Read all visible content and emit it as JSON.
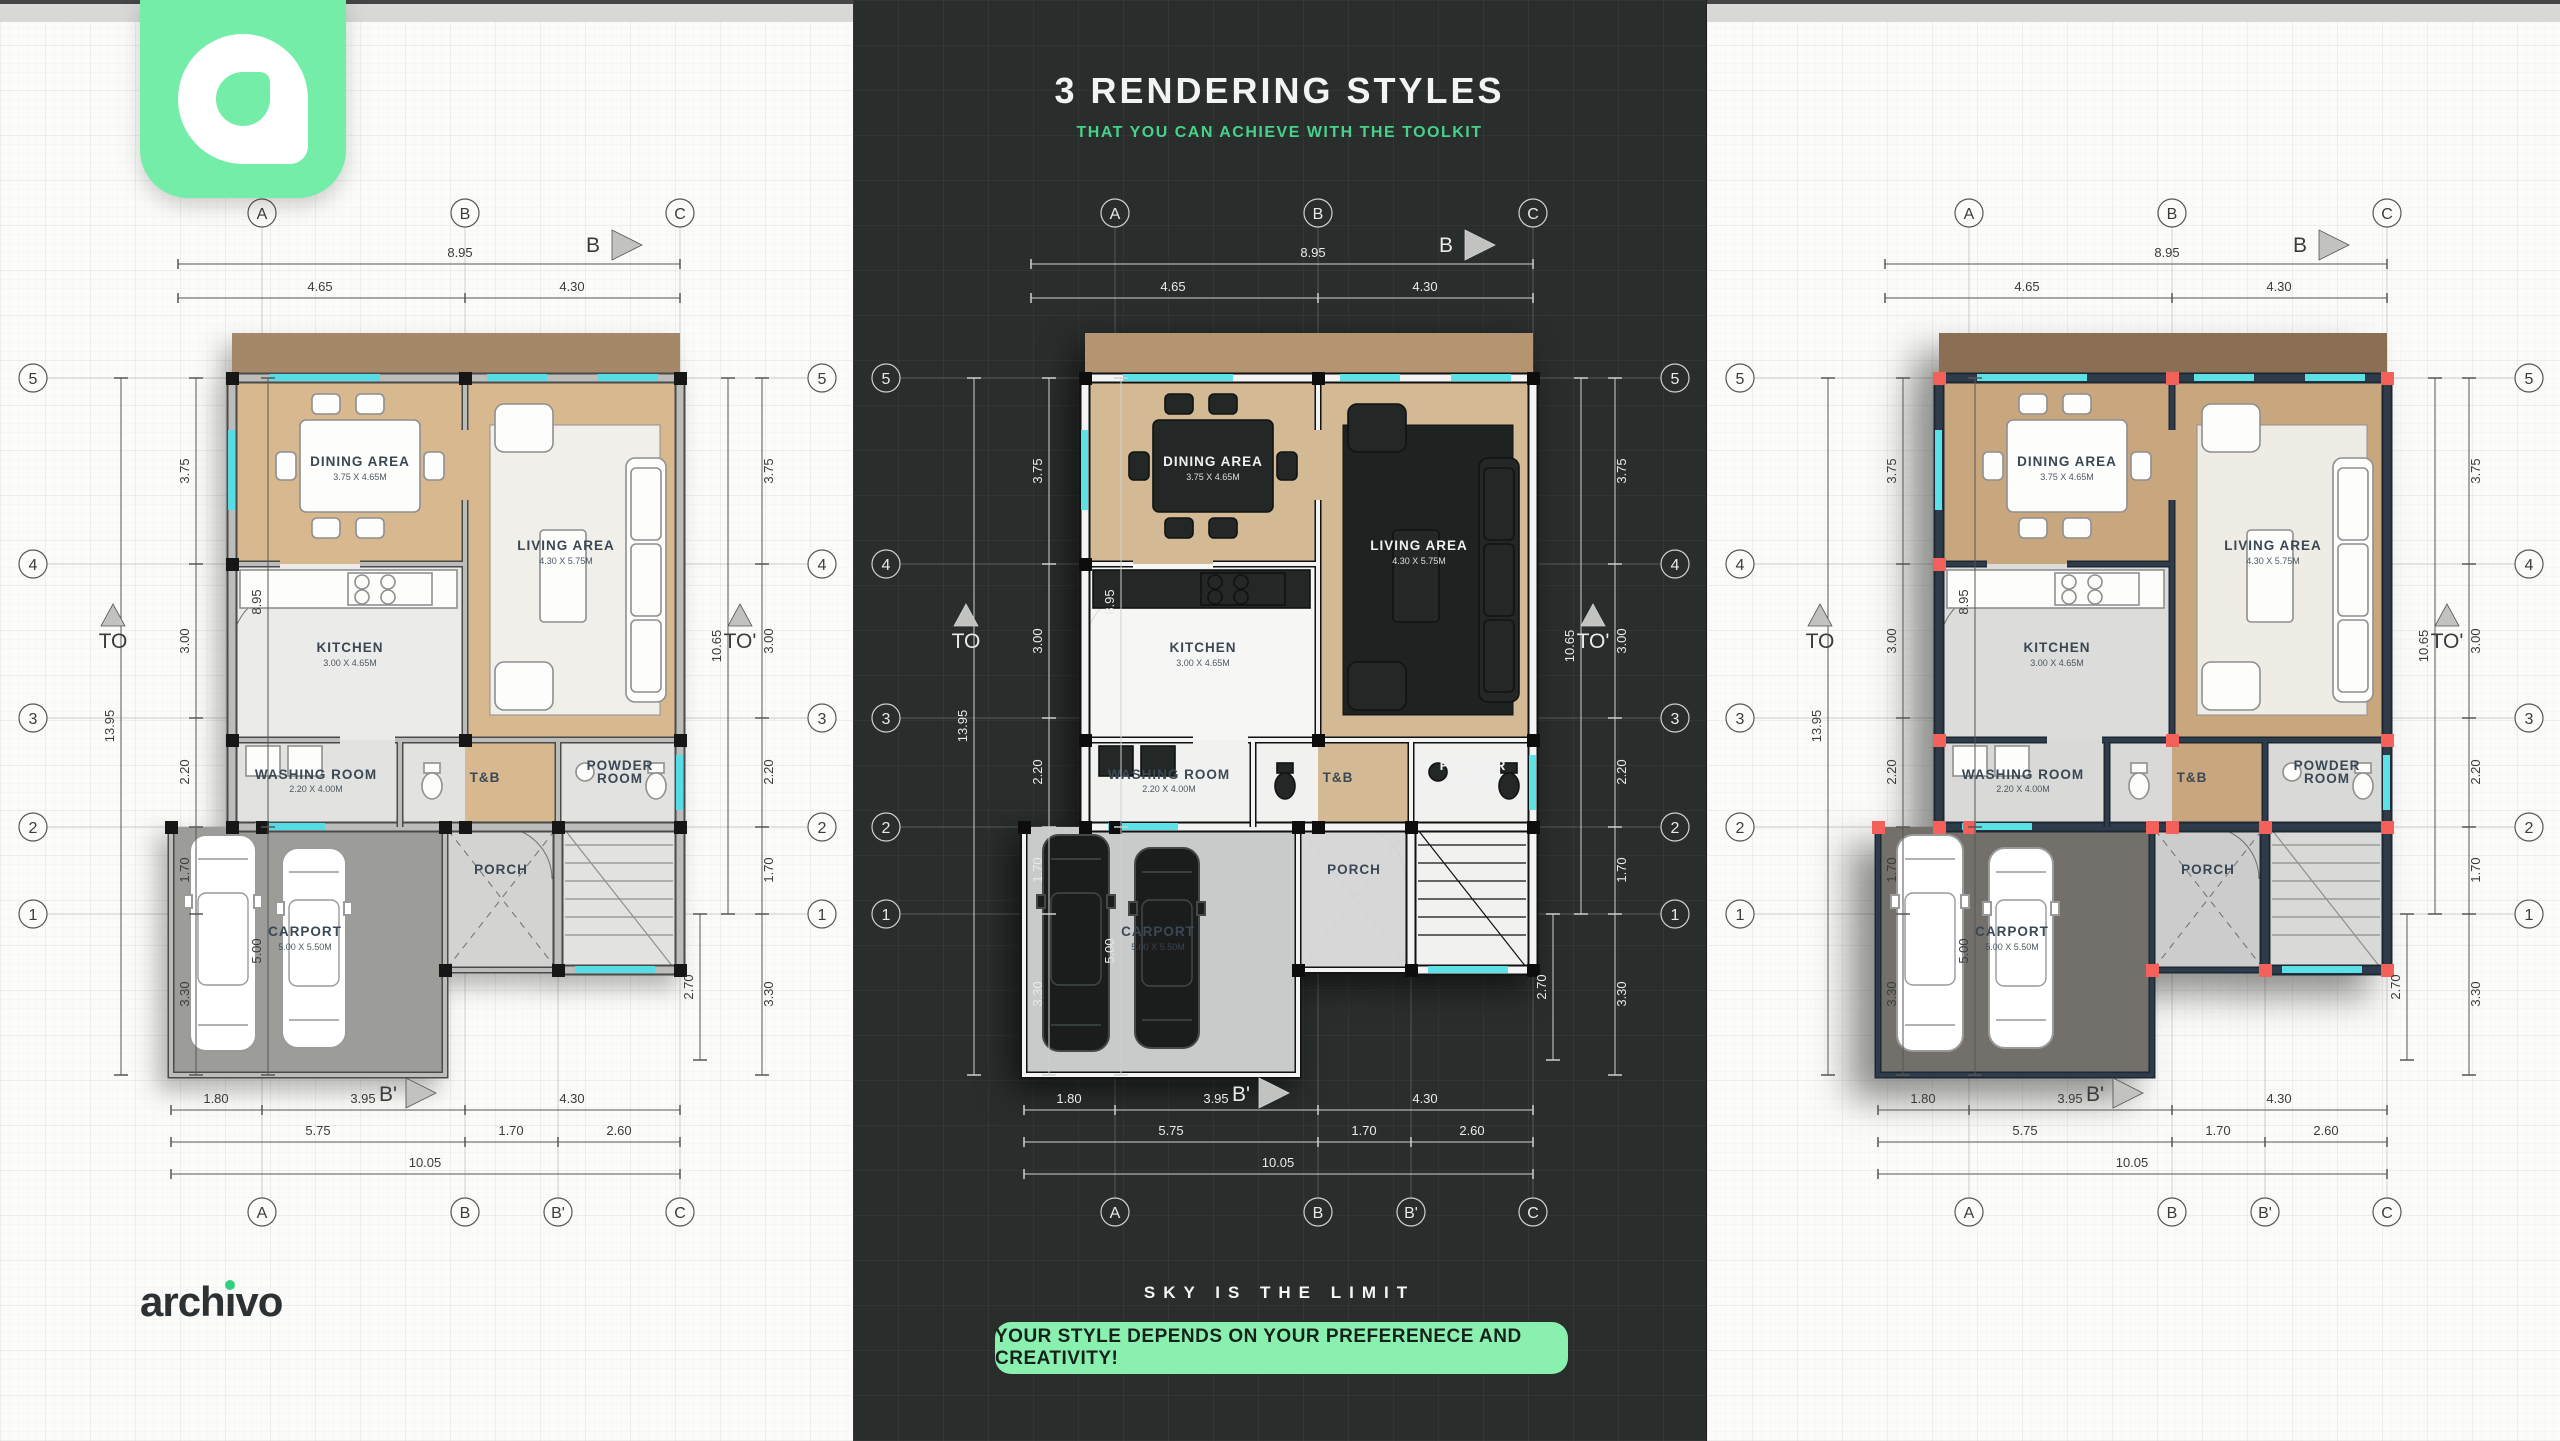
{
  "header": {
    "title": "3 RENDERING STYLES",
    "subtitle": "THAT YOU CAN ACHIEVE WITH THE TOOLKIT"
  },
  "footer": {
    "tagline": "SKY IS THE LIMIT",
    "button_label": "YOUR STYLE DEPENDS ON YOUR PREFERENECE AND CREATIVITY!"
  },
  "brand": {
    "name": "archivo",
    "wordmark_pre": "arch",
    "wordmark_i": "ı",
    "wordmark_post": "vo"
  },
  "colors": {
    "accent_green": "#8af0b0",
    "subtitle_green": "#46d389",
    "dark_bg": "#292d2c",
    "red_marker": "#f4605a",
    "cyan_window": "#55dce4"
  },
  "plan": {
    "rooms": {
      "dining": {
        "name": "DINING AREA",
        "dims": "3.75 X 4.65M"
      },
      "living": {
        "name": "LIVING AREA",
        "dims": "4.30 X 5.75M"
      },
      "kitchen": {
        "name": "KITCHEN",
        "dims": "3.00 X 4.65M"
      },
      "washing": {
        "name": "WASHING ROOM",
        "dims": "2.20 X 4.00M"
      },
      "tb": {
        "name": "T&B"
      },
      "powder": {
        "line1": "POWDER",
        "line2": "ROOM"
      },
      "porch": {
        "name": "PORCH"
      },
      "carport": {
        "name": "CARPORT",
        "dims": "5.00 X 5.50M"
      }
    },
    "grid": {
      "cols_top": [
        "A",
        "B",
        "C"
      ],
      "cols_bottom": [
        "A",
        "B",
        "B'",
        "C"
      ],
      "rows": [
        "5",
        "4",
        "3",
        "2",
        "1"
      ],
      "section_top": "B",
      "section_bottom": "B'",
      "elev_left": "TO",
      "elev_right": "TO'"
    },
    "dims": {
      "top_total": "8.95",
      "top_segs": [
        "4.65",
        "4.30"
      ],
      "left_segs": [
        "3.75",
        "3.00",
        "2.20",
        "1.70",
        "3.30"
      ],
      "left_span_upper": "8.95",
      "left_span_lower": "5.00",
      "left_total": "13.95",
      "right_span": "10.65",
      "right_lower": "2.70",
      "bottom_row1": [
        "1.80",
        "3.95",
        "4.30"
      ],
      "bottom_row2": [
        "5.75",
        "1.70",
        "2.60"
      ],
      "bottom_total": "10.05"
    }
  }
}
